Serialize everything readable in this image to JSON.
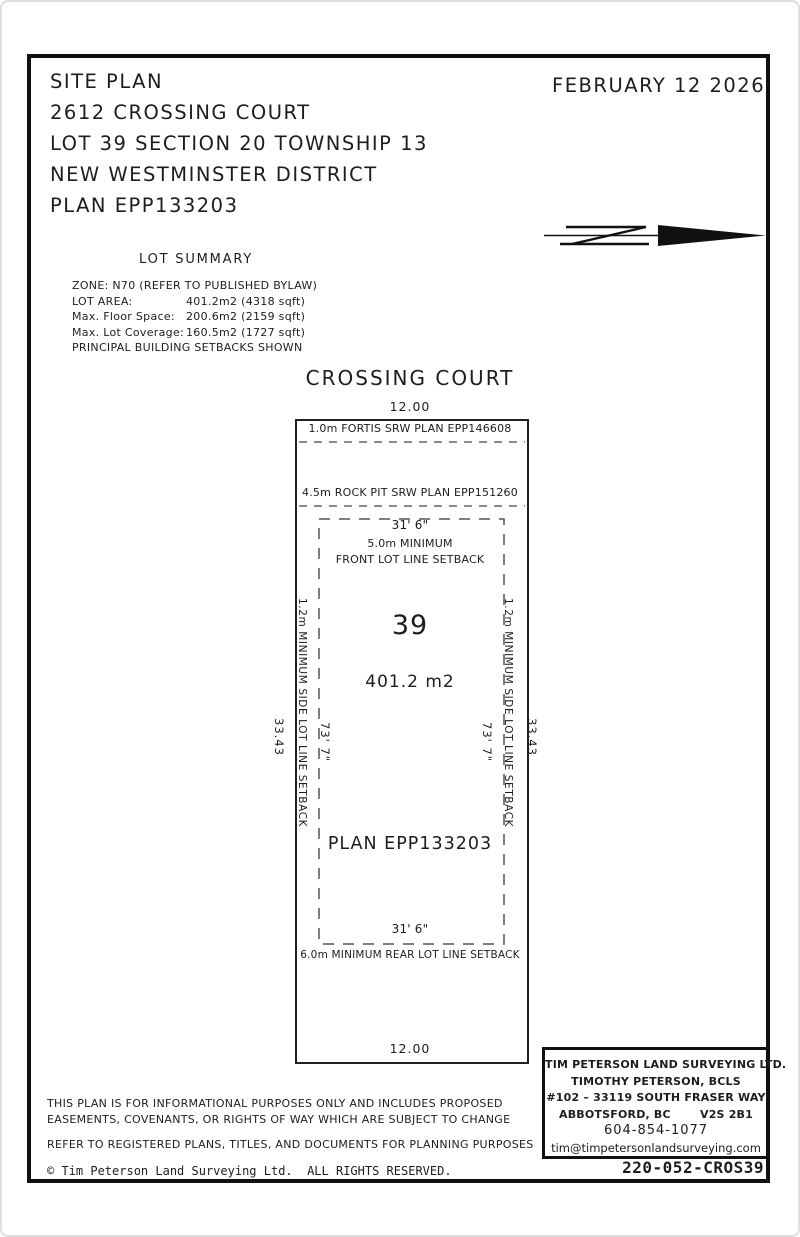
{
  "header": {
    "title_lines": [
      "SITE PLAN",
      "2612 CROSSING COURT",
      "LOT 39 SECTION 20 TOWNSHIP 13",
      "NEW WESTMINSTER DISTRICT",
      "PLAN EPP133203"
    ],
    "date": "FEBRUARY 12 2026",
    "north_arrow": "north-arrow pointing right with rotated N glyph"
  },
  "lot_summary": {
    "heading": "LOT SUMMARY",
    "zone_line": "ZONE: N70 (REFER TO PUBLISHED BYLAW)",
    "rows": [
      {
        "label": "LOT AREA:",
        "value": "401.2m2 (4318 sqft)"
      },
      {
        "label": "Max. Floor Space:",
        "value": "200.6m2 (2159 sqft)"
      },
      {
        "label": "Max. Lot Coverage:",
        "value": "160.5m2 (1727 sqft)"
      }
    ],
    "footer_line": "PRINCIPAL BUILDING SETBACKS SHOWN"
  },
  "plan": {
    "street_name": "CROSSING COURT",
    "front_dimension": "12.00",
    "rear_dimension": "12.00",
    "side_dimension": "33.43",
    "fortis_srw": "1.0m FORTIS SRW PLAN EPP146608",
    "rock_pit_srw": "4.5m ROCK PIT SRW PLAN EPP151260",
    "front_setback_width": "31' 6\"",
    "front_setback_line1": "5.0m MINIMUM",
    "front_setback_line2": "FRONT LOT LINE SETBACK",
    "lot_number": "39",
    "lot_area": "401.2 m2",
    "plan_number": "PLAN EPP133203",
    "setback_depth": "73' 7\"",
    "side_setback_label": "1.2m MINIMUM SIDE LOT LINE SETBACK",
    "rear_setback_width": "31' 6\"",
    "rear_setback_label": "6.0m MINIMUM REAR LOT LINE SETBACK"
  },
  "disclaimer": {
    "line1": "THIS PLAN IS FOR INFORMATIONAL PURPOSES ONLY AND INCLUDES PROPOSED",
    "line2": "EASEMENTS, COVENANTS, OR RIGHTS OF WAY WHICH ARE SUBJECT TO CHANGE",
    "line3": "REFER TO REGISTERED PLANS, TITLES, AND DOCUMENTS FOR PLANNING PURPOSES"
  },
  "surveyor_box": {
    "company": "TIM PETERSON LAND SURVEYING LTD.",
    "surveyor": "TIMOTHY PETERSON, BCLS",
    "address": "#102 – 33119 SOUTH FRASER WAY",
    "city": "ABBOTSFORD, BC",
    "postal": "V2S 2B1",
    "phone": "604-854-1077",
    "email": "tim@timpetersonlandsurveying.com"
  },
  "footer": {
    "copyright": "© Tim Peterson Land Surveying Ltd.  ALL RIGHTS RESERVED.",
    "reference": "220-052-CROS39"
  },
  "colors": {
    "ink": "#1d1d1d",
    "paper": "#ffffff",
    "dashed_line": "#666666"
  }
}
